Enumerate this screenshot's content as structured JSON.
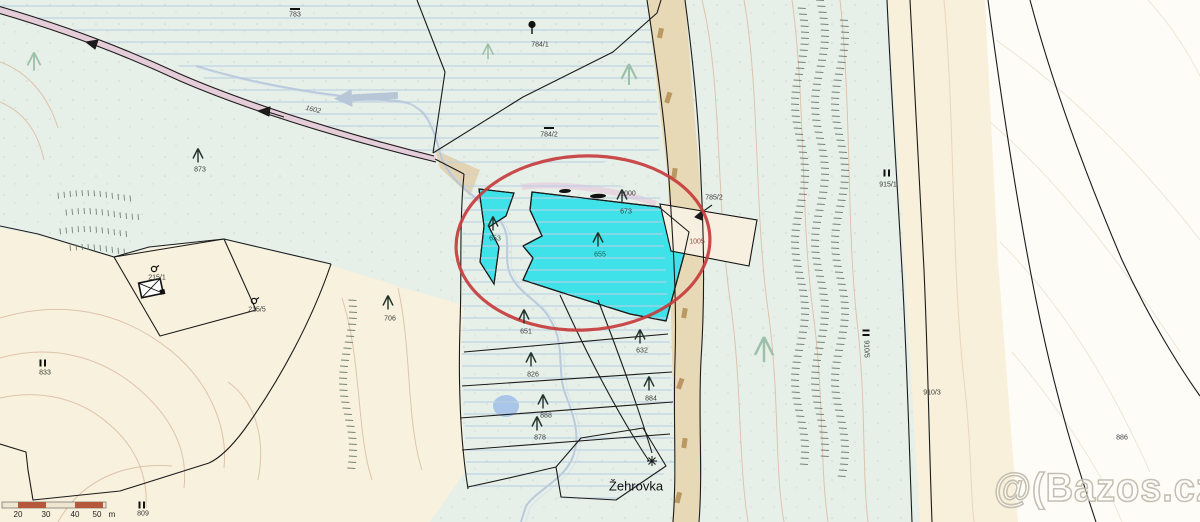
{
  "map": {
    "watermark_text": "@(Bazos.cz",
    "stream_label": "Žehrovka",
    "road_label": "1602",
    "scale_bar": {
      "tick_labels": [
        "20",
        "30",
        "40",
        "50"
      ],
      "unit_label": "m",
      "tick_x": [
        18,
        46,
        75,
        97
      ],
      "unit_x": 112
    },
    "colors": {
      "meadow": "#e7f0e8",
      "cream": "#f8f1dd",
      "white_zone": "#fdfcf7",
      "hatch_blue": "#b9cfe2",
      "contour_tan": "#dcbfa6",
      "highlight_parcel": "#3fe2e8",
      "annotation_circle": "#c63c3c",
      "stream_blue": "#b5c5da",
      "track_fill": "#e8d9b6",
      "scale_red": "#b4573b"
    },
    "parcel_labels": [
      {
        "text": "783",
        "x": 295,
        "y": 15
      },
      {
        "text": "784/1",
        "x": 540,
        "y": 45
      },
      {
        "text": "784/2",
        "x": 549,
        "y": 135
      },
      {
        "text": "873",
        "x": 200,
        "y": 170
      },
      {
        "text": "1000",
        "x": 628,
        "y": 194
      },
      {
        "text": "673",
        "x": 626,
        "y": 212
      },
      {
        "text": "655",
        "x": 600,
        "y": 255,
        "color": "#1e5e52"
      },
      {
        "text": "653",
        "x": 495,
        "y": 239,
        "color": "#1e5e52"
      },
      {
        "text": "1005",
        "x": 697,
        "y": 242,
        "color": "#9c4a42"
      },
      {
        "text": "785/2",
        "x": 714,
        "y": 198
      },
      {
        "text": "915/1",
        "x": 888,
        "y": 185
      },
      {
        "text": "910/5",
        "x": 866,
        "y": 349,
        "rotate": 90
      },
      {
        "text": "910/3",
        "x": 932,
        "y": 393
      },
      {
        "text": "886",
        "x": 1122,
        "y": 438
      },
      {
        "text": "215/1",
        "x": 157,
        "y": 278
      },
      {
        "text": "215/5",
        "x": 257,
        "y": 310
      },
      {
        "text": "706",
        "x": 390,
        "y": 319
      },
      {
        "text": "833",
        "x": 45,
        "y": 373
      },
      {
        "text": "651",
        "x": 526,
        "y": 332
      },
      {
        "text": "632",
        "x": 642,
        "y": 351
      },
      {
        "text": "826",
        "x": 533,
        "y": 375
      },
      {
        "text": "884",
        "x": 651,
        "y": 399
      },
      {
        "text": "888",
        "x": 546,
        "y": 416
      },
      {
        "text": "878",
        "x": 540,
        "y": 438
      },
      {
        "text": "809",
        "x": 143,
        "y": 514
      }
    ],
    "symbols": [
      {
        "type": "conifer-tree-icon",
        "x": 198,
        "y": 158
      },
      {
        "type": "conifer-tree-icon",
        "x": 388,
        "y": 305
      },
      {
        "type": "conifer-tree-icon",
        "x": 493,
        "y": 226
      },
      {
        "type": "conifer-tree-icon",
        "x": 598,
        "y": 242
      },
      {
        "type": "conifer-tree-icon",
        "x": 622,
        "y": 199
      },
      {
        "type": "conifer-tree-icon",
        "x": 524,
        "y": 319
      },
      {
        "type": "conifer-tree-icon",
        "x": 640,
        "y": 339
      },
      {
        "type": "conifer-tree-icon",
        "x": 531,
        "y": 362
      },
      {
        "type": "conifer-tree-icon",
        "x": 649,
        "y": 386
      },
      {
        "type": "conifer-tree-icon",
        "x": 543,
        "y": 404
      },
      {
        "type": "conifer-tree-icon",
        "x": 537,
        "y": 426
      },
      {
        "type": "conifer-tree-pale-icon",
        "x": 34,
        "y": 64,
        "s": 1.3
      },
      {
        "type": "conifer-tree-pale-icon",
        "x": 488,
        "y": 54,
        "s": 1.1
      },
      {
        "type": "conifer-tree-pale-icon",
        "x": 629,
        "y": 77,
        "s": 1.5
      },
      {
        "type": "conifer-tree-pale-icon",
        "x": 764,
        "y": 352,
        "s": 1.8
      },
      {
        "type": "deciduous-tree-icon",
        "x": 532,
        "y": 30
      },
      {
        "type": "meadow-dash-icon",
        "x": 295,
        "y": 7
      },
      {
        "type": "meadow-dash-icon",
        "x": 549,
        "y": 126
      },
      {
        "type": "double-bar-icon",
        "x": 887,
        "y": 173
      },
      {
        "type": "double-bar-icon",
        "x": 43,
        "y": 363
      },
      {
        "type": "double-bar-icon",
        "x": 142,
        "y": 505
      },
      {
        "type": "double-bar-icon",
        "x": 866,
        "y": 333,
        "r": 90
      },
      {
        "type": "garden-icon",
        "x": 155,
        "y": 269
      },
      {
        "type": "garden-icon",
        "x": 255,
        "y": 301
      },
      {
        "type": "star-icon",
        "x": 652,
        "y": 462
      },
      {
        "type": "building-icon",
        "x": 152,
        "y": 291
      }
    ]
  }
}
